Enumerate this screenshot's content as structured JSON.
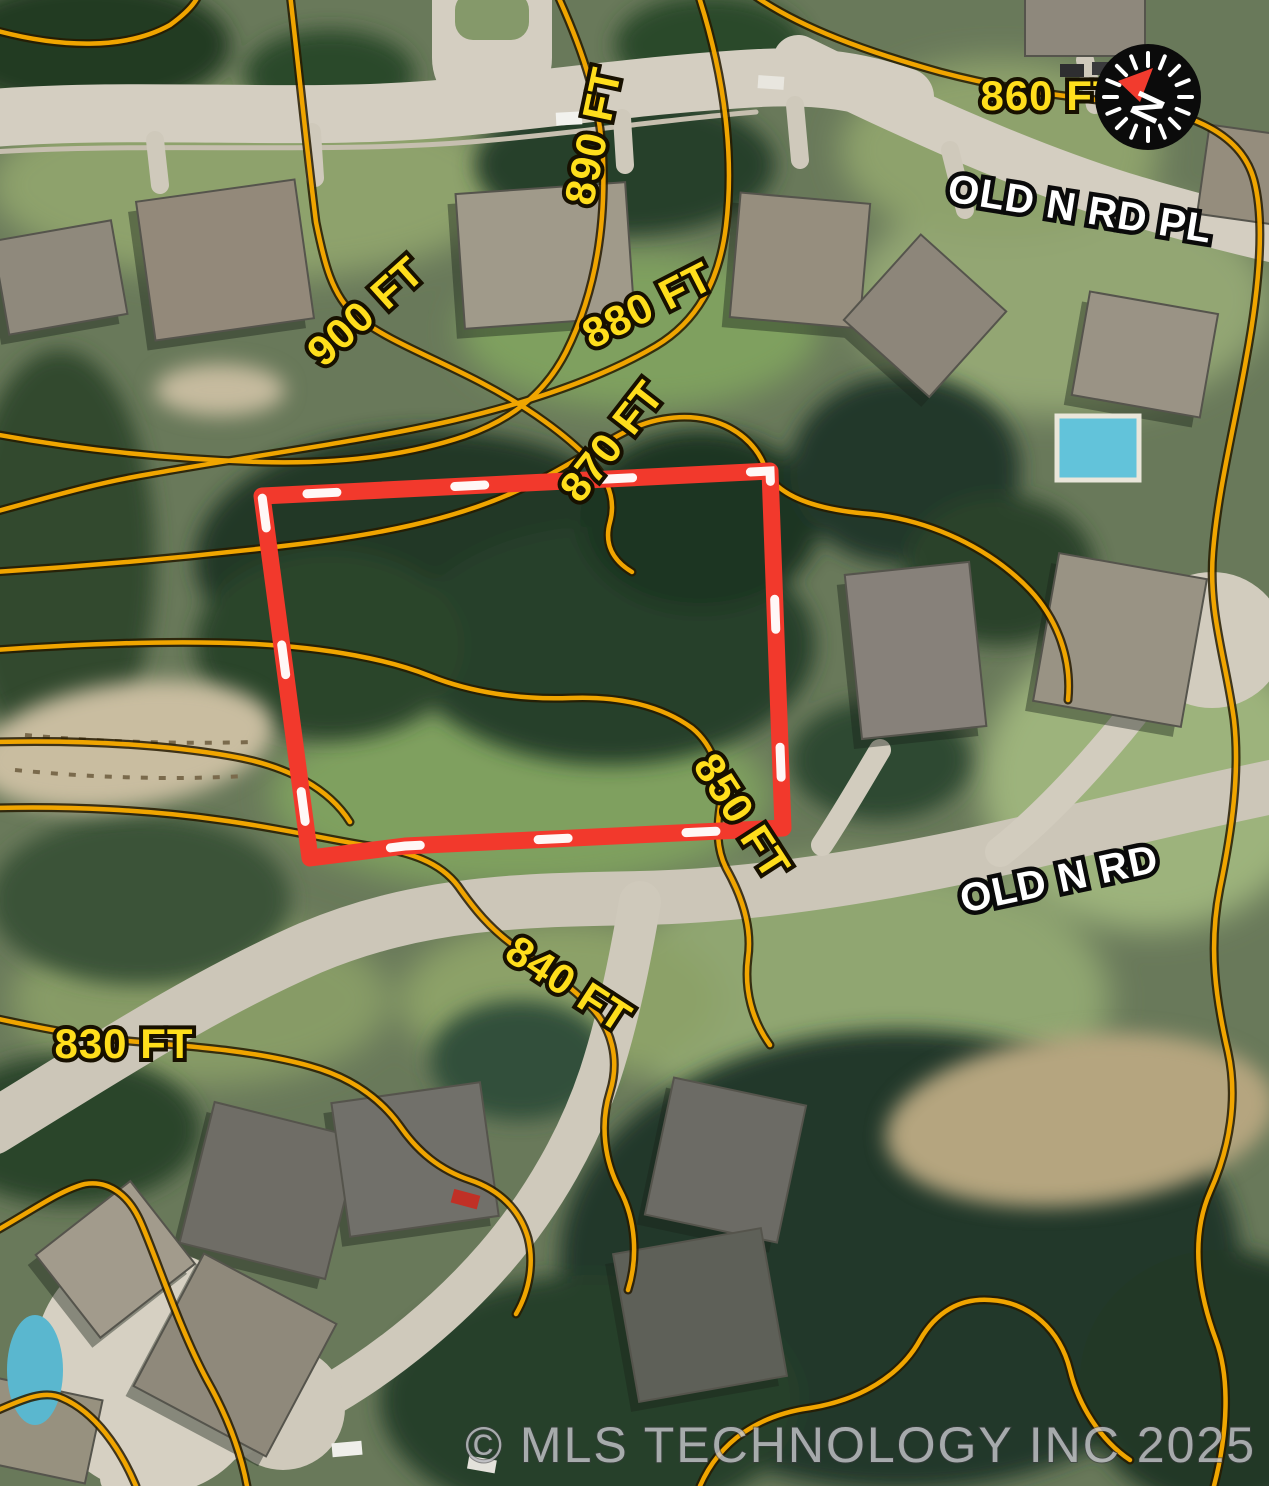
{
  "map": {
    "compass": {
      "letter": "N"
    },
    "streets": {
      "old_n_rd_pl": "OLD N RD PL",
      "old_n_rd": "OLD N RD"
    },
    "elevations": {
      "e860": "860 FT",
      "e890": "890 FT",
      "e900": "900 FT",
      "e880": "880 FT",
      "e870": "870 FT",
      "e850": "850 FT",
      "e840": "840 FT",
      "e830": "830 FT"
    },
    "watermark": "© MLS TECHNOLOGY INC 2025",
    "colors": {
      "contour_line": "#F0A500",
      "contour_outline": "#261B00",
      "boundary_red": "#F2392C",
      "boundary_dash": "#FFFFFF",
      "elevation_text": "#FFDE1C",
      "street_text": "#FFFFFF",
      "road": "#D3CDBF",
      "watermark_text": "#CBCBCF",
      "compass_bg": "#0B0B0B",
      "compass_needle": "#F23B2E"
    }
  }
}
